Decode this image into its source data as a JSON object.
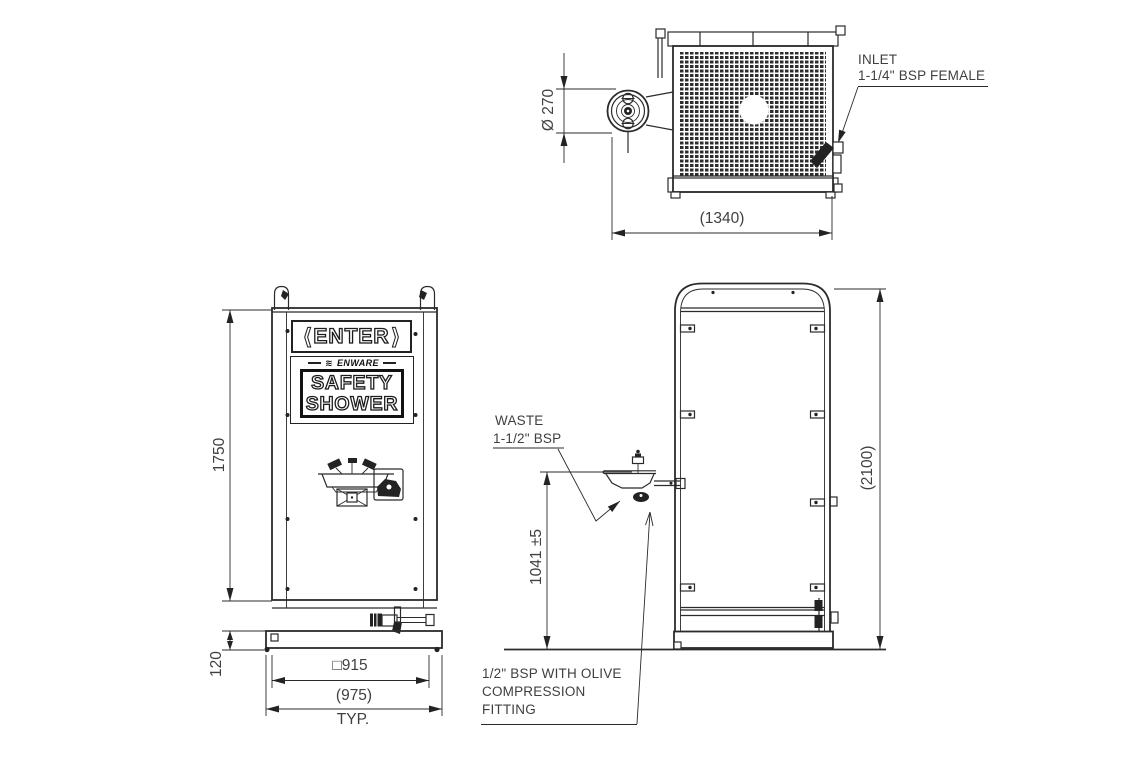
{
  "top_view": {
    "dim_diameter": "Ø 270",
    "dim_width": "(1340)",
    "inlet_line1": "INLET",
    "inlet_line2": "1-1/4\" BSP FEMALE"
  },
  "front_view": {
    "sign_enter": {
      "left_arrow": "⟨",
      "text": "ENTER",
      "right_arrow": "⟩"
    },
    "sign_shower": {
      "brand_prefix": "≋",
      "brand": "ENWARE",
      "line1": "SAFETY",
      "line2": "SHOWER"
    },
    "dim_height": "1750",
    "dim_base_height": "120",
    "dim_width_panel": "□915",
    "dim_width_base": "(975)",
    "dim_typ": "TYP."
  },
  "side_view": {
    "dim_overall": "(2100)",
    "dim_bowl_height": "1041 ±5",
    "waste_line1": "WASTE",
    "waste_line2": "1-1/2\" BSP",
    "fitting_line1": "1/2\" BSP WITH OLIVE",
    "fitting_line2": "COMPRESSION",
    "fitting_line3": "FITTING"
  },
  "colors": {
    "line": "#2b2b2b",
    "text": "#404040",
    "background": "#ffffff"
  }
}
